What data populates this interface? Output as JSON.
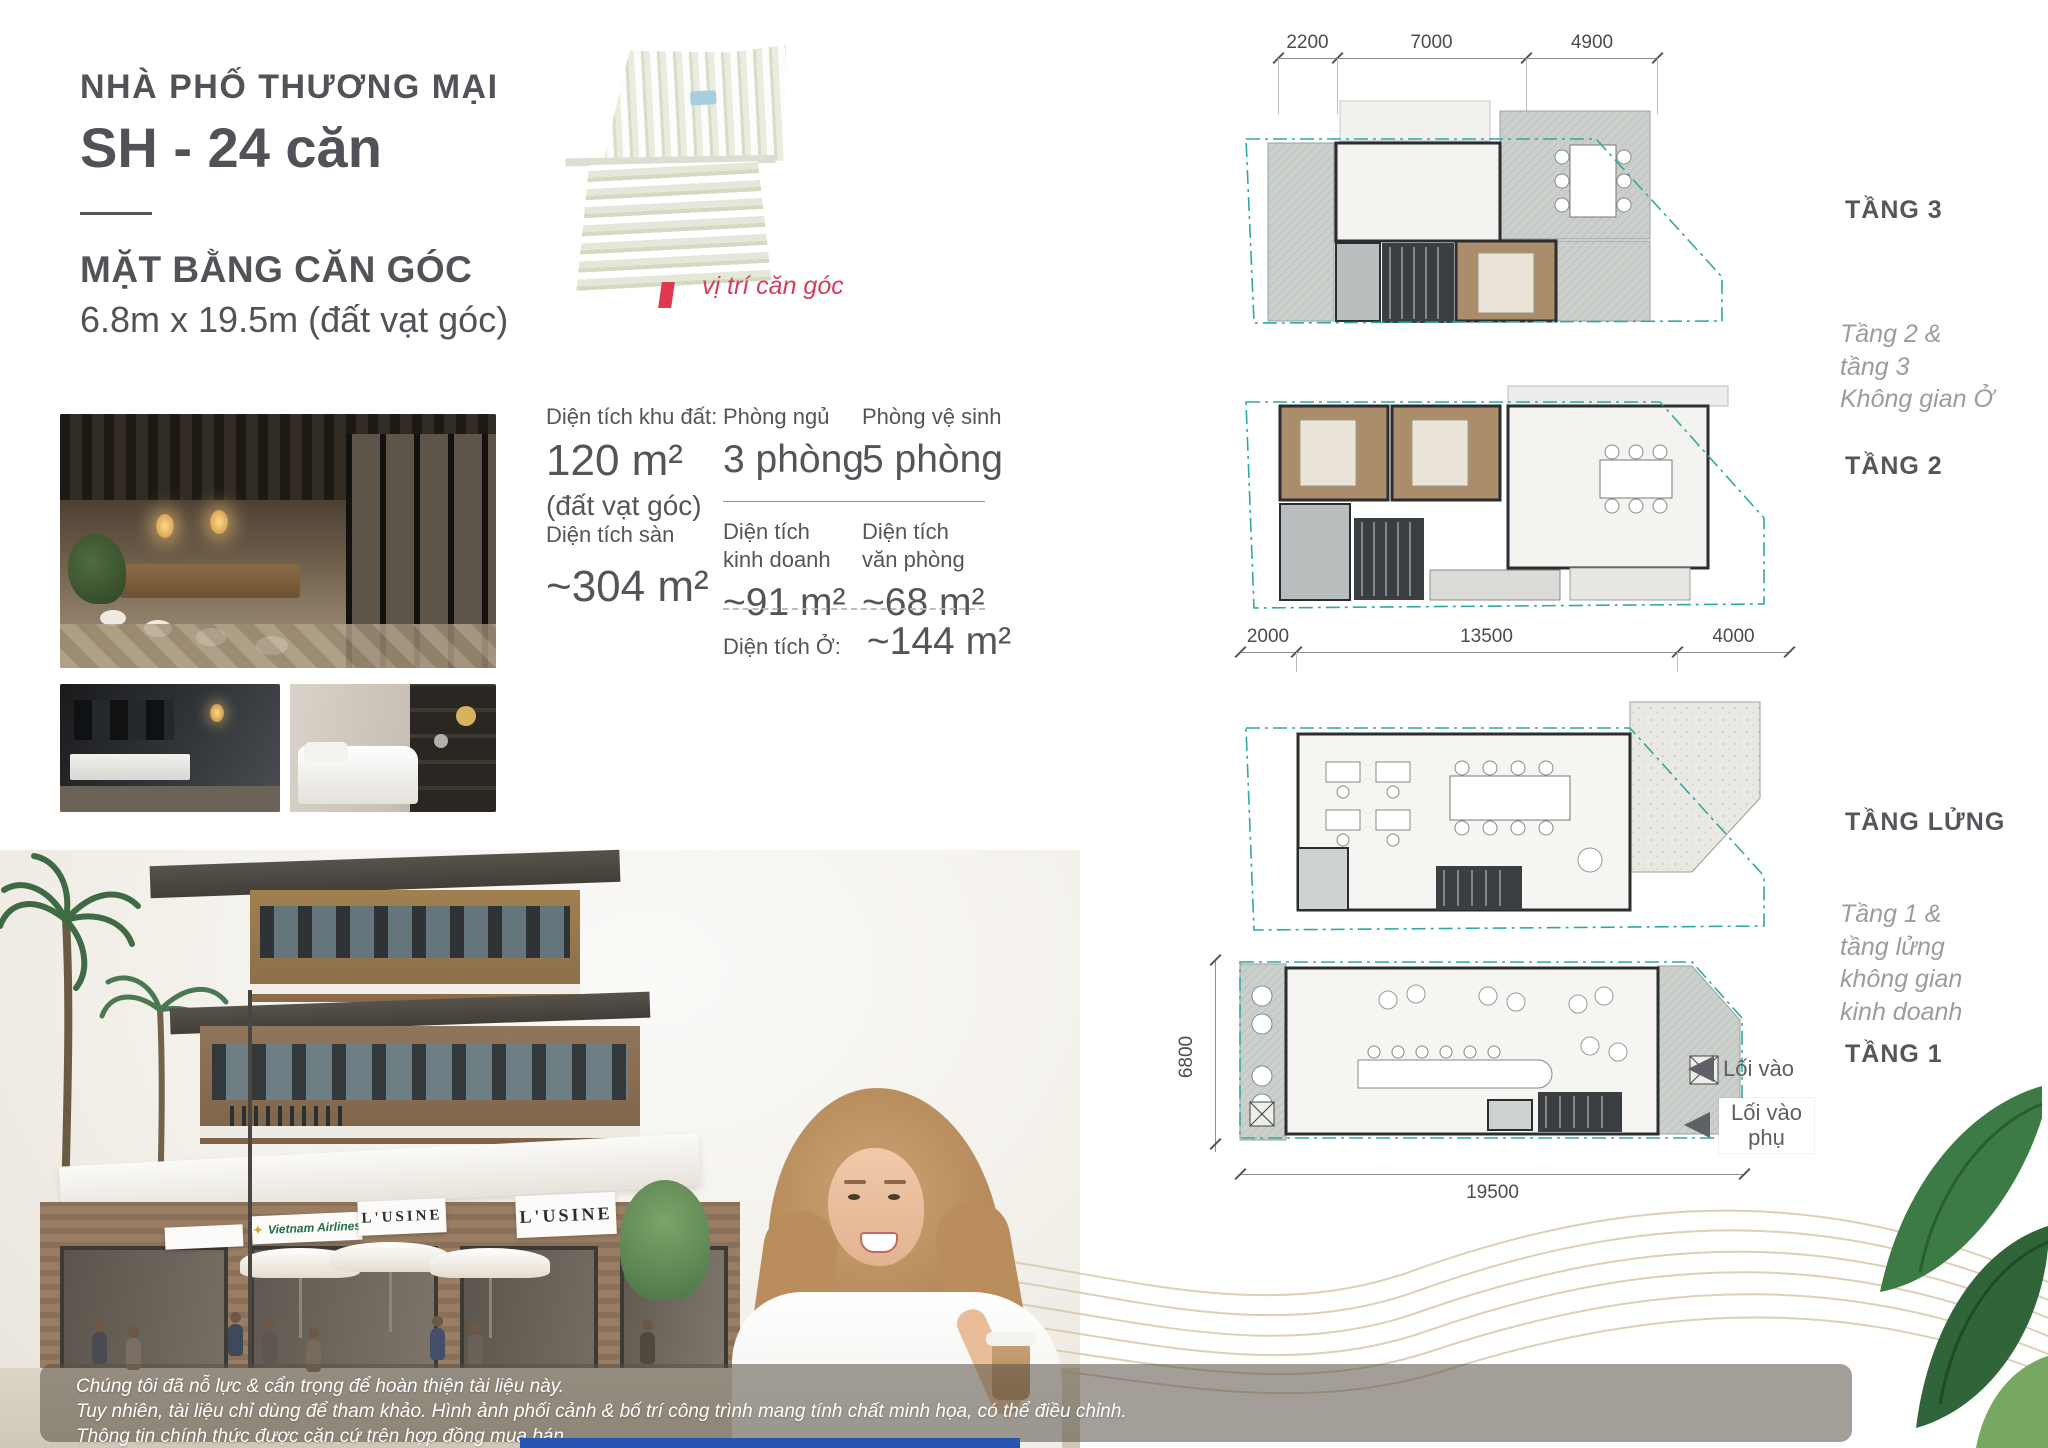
{
  "header": {
    "category": "NHÀ PHỐ THƯƠNG MẠI",
    "title": "SH - 24 căn",
    "plan_heading": "MẶT BẰNG CĂN GÓC",
    "plan_size": "6.8m x 19.5m (đất vạt góc)"
  },
  "site_map": {
    "marker_label": "vị trí căn góc"
  },
  "specs": {
    "land_label": "Diện tích khu đất:",
    "land_value": "120 m²",
    "land_note": "(đất vạt góc)",
    "bedroom_label": "Phòng ngủ",
    "bedroom_value": "3 phòng",
    "bathroom_label": "Phòng vệ sinh",
    "bathroom_value": "5 phòng",
    "floor_label": "Diện tích sàn",
    "floor_value": "~304 m²",
    "business_label": "Diện tích\nkinh doanh",
    "business_value": "~91 m²",
    "office_label": "Diện tích\nvăn phòng",
    "office_value": "~68 m²",
    "living_label": "Diện tích Ở:",
    "living_value": "~144 m²"
  },
  "floor_plans": {
    "t3_label": "TẦNG 3",
    "t2_label": "TẦNG 2",
    "mezz_label": "TẦNG LỬNG",
    "t1_label": "TẦNG 1",
    "upper_caption": "Tầng 2 &\ntầng 3\nKhông gian Ở",
    "lower_caption": "Tầng 1 &\ntầng lửng\nkhông gian\nkinh doanh",
    "dims_top": [
      "2200",
      "7000",
      "4900"
    ],
    "dims_mid": [
      "2000",
      "13500",
      "4000"
    ],
    "dim_width": "19500",
    "dim_height": "6800",
    "entry_label": "Lối vào",
    "entry_secondary_label": "Lối vào\nphụ"
  },
  "hero": {
    "signs": [
      "Vietnam Airlines",
      "L'USINE",
      "L'USINE"
    ]
  },
  "disclaimer": {
    "lines": [
      "Chúng tôi đã nỗ lực & cẩn trọng để hoàn thiện tài liệu này.",
      "Tuy nhiên, tài liệu chỉ dùng để tham khảo. Hình ảnh phối cảnh & bố trí công trình mang tính chất minh họa, có thể điều chỉnh.",
      "Thông tin chính thức được căn cứ trên hợp đồng mua bán."
    ]
  },
  "colors": {
    "accent_red": "#d6395c",
    "plan_teal": "#2fa9a2",
    "text_dark": "#54555a",
    "text_light": "#9b9ca1"
  }
}
